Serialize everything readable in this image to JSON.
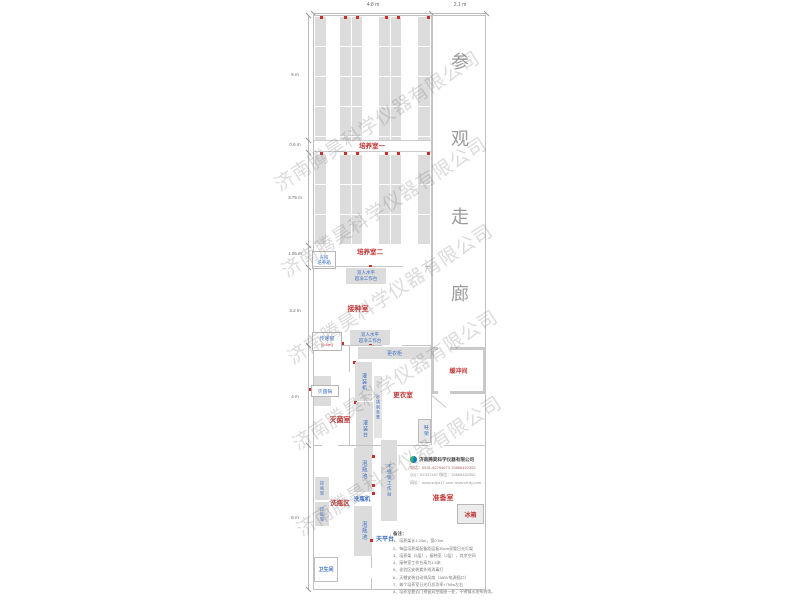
{
  "colors": {
    "label_red": "#c23535",
    "label_blue": "#3a6fc4",
    "wall_gray": "#c4c4c4",
    "fill_gray": "#dcdcdc"
  },
  "dimensions": {
    "top": {
      "d1": "4.8 m",
      "d2": "2.1 m"
    },
    "left": {
      "d1": "5 m",
      "d2": "0.6 m",
      "d3": "3.75 m",
      "d4": "1.05 m",
      "d5": "3.2 m",
      "d6": "4 m",
      "d7": "6 m"
    }
  },
  "corridor": {
    "name": "参观走廊",
    "chars": [
      "参",
      "观",
      "走",
      "廊"
    ]
  },
  "watermark": {
    "text": "济南腾昊科学仪器有限公司"
  },
  "rooms": {
    "culture1": "培养室一",
    "culture2": "培养室二",
    "inoculation": "接种室",
    "buffer": "缓冲间",
    "changing": "更衣室",
    "sterilization": "灭菌室",
    "washing_area": "洗瓶区",
    "preparation": "准备室",
    "toilet": "卫生间"
  },
  "equipment": {
    "light_incubator": "光照\n培养箱",
    "clean_bench_1": "双人水平\n超净工作台",
    "clean_bench_2": "双人水平\n超净工作台",
    "pass_window": "传递窗",
    "pass_window_area": "(0.6㎡)",
    "autoclave": "灭菌锅",
    "filling_machine": "灌装机",
    "filling_table": "灌装台",
    "steel_bench": "不锈钢条凳",
    "wardrobe": "更衣柜",
    "shoe_rack": "鞋架",
    "bottle_rack_1": "控瓶架",
    "bottle_rack_2": "控瓶架",
    "soak_pool_1": "泡瓶池",
    "soak_pool_2": "泡瓶池",
    "bottle_washer": "洗瓶机",
    "steel_worktable": "不锈钢工作台",
    "balance_table": "天平台",
    "fridge": "冰箱"
  },
  "company": {
    "name": "济南腾昊科学仪器有限公司",
    "phone_line": "电话：0531-82794673  15866452352",
    "qq_line": "QQ：87437467  微信：15866452352",
    "web_line": "网址：www.sdpd17.com  www.crhkj.com"
  },
  "notes": {
    "header": "备注：",
    "items": [
      "1、培养架长1.25m，宽0.5m",
      "2、每层培养架配备距层板30cm双管日光灯架",
      "3、培养架（5层），接种室（2层），其余空间",
      "4、接种室工作台高为1.5米",
      "5、化验区安装紫外线消毒灯",
      "6、天棚安装自动排风扇（380V电源插口）",
      "7、每个培养室日光灯总功率×750w左右",
      "8、培养室靠近门预留双控插座一处，不锈钢水池布线等。"
    ]
  }
}
